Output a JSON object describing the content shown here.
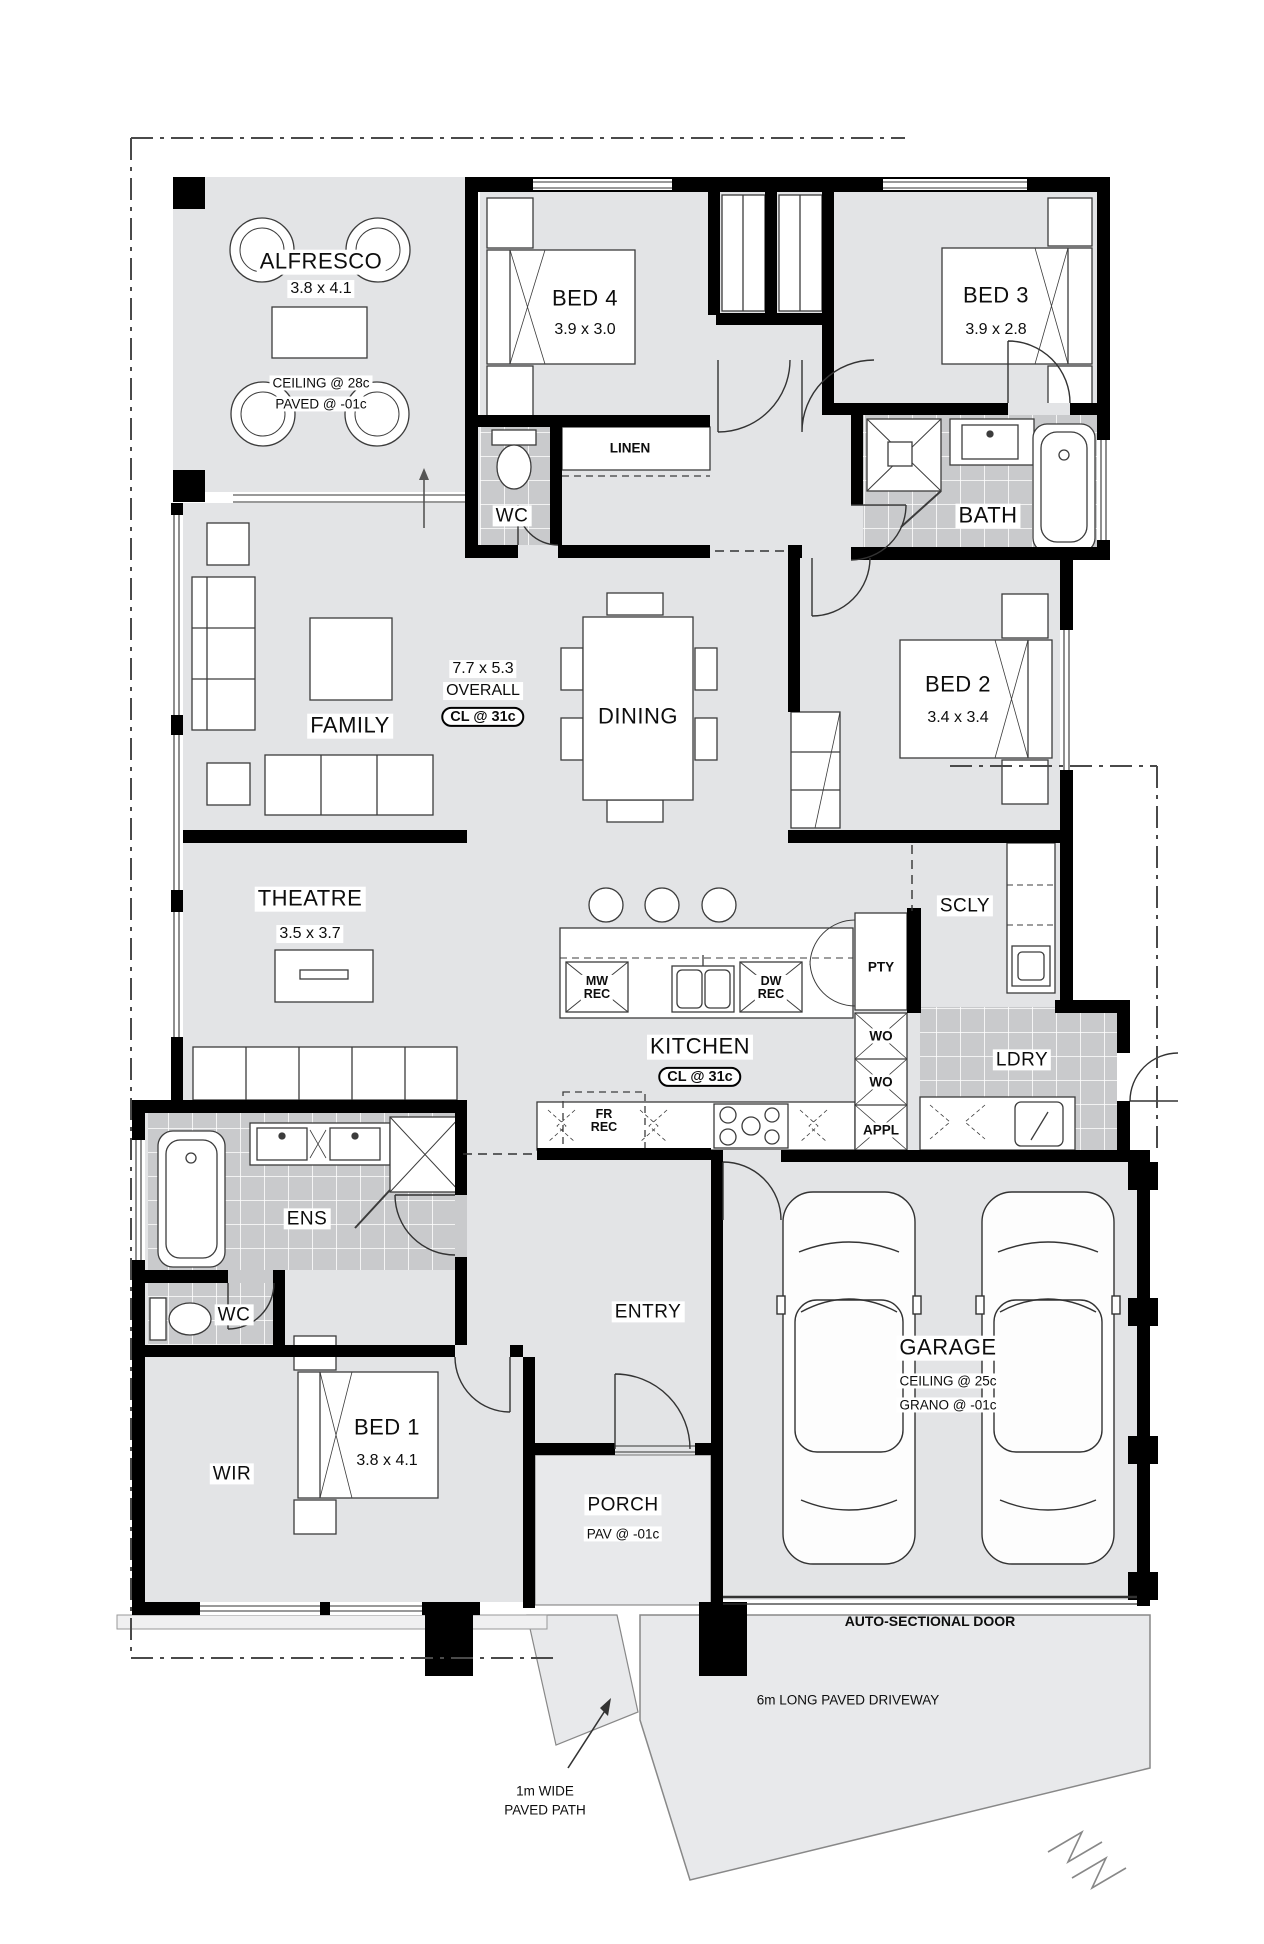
{
  "rooms": {
    "alfresco": {
      "name": "ALFRESCO",
      "dims": "3.8 x 4.1",
      "note1": "CEILING @ 28c",
      "note2": "PAVED @ -01c"
    },
    "bed4": {
      "name": "BED 4",
      "dims": "3.9 x 3.0"
    },
    "bed3": {
      "name": "BED 3",
      "dims": "3.9 x 2.8"
    },
    "wc_top": {
      "name": "WC"
    },
    "linen": {
      "name": "LINEN"
    },
    "bath": {
      "name": "BATH"
    },
    "family": {
      "name": "FAMILY"
    },
    "dining": {
      "name": "DINING"
    },
    "bed2": {
      "name": "BED 2",
      "dims": "3.4 x 3.4"
    },
    "theatre": {
      "name": "THEATRE",
      "dims": "3.5 x 3.7"
    },
    "scly": {
      "name": "SCLY"
    },
    "kitchen": {
      "name": "KITCHEN",
      "ceiling": "CL @ 31c"
    },
    "ldry": {
      "name": "LDRY"
    },
    "ens": {
      "name": "ENS"
    },
    "wc_ens": {
      "name": "WC"
    },
    "bed1": {
      "name": "BED 1",
      "dims": "3.8 x 4.1"
    },
    "wir": {
      "name": "WIR"
    },
    "entry": {
      "name": "ENTRY"
    },
    "porch": {
      "name": "PORCH",
      "note": "PAV @ -01c"
    },
    "garage": {
      "name": "GARAGE",
      "note1": "CEILING @ 25c",
      "note2": "GRANO @ -01c"
    }
  },
  "living_overall": {
    "dims": "7.7 x 5.3",
    "label": "OVERALL",
    "ceiling": "CL @ 31c"
  },
  "fixtures": {
    "mw": {
      "l1": "MW",
      "l2": "REC"
    },
    "dw": {
      "l1": "DW",
      "l2": "REC"
    },
    "fr": {
      "l1": "FR",
      "l2": "REC"
    },
    "pty": "PTY",
    "wo1": "WO",
    "wo2": "WO",
    "appl": "APPL"
  },
  "annotations": {
    "auto_door": "AUTO-SECTIONAL DOOR",
    "driveway": "6m LONG PAVED DRIVEWAY",
    "path_line1": "1m WIDE",
    "path_line2": "PAVED PATH"
  },
  "colors": {
    "wall": "#000000",
    "floor": "#e3e4e6",
    "tile": "#c9cacc",
    "paving": "#e8e9eb",
    "line": "#333333"
  }
}
